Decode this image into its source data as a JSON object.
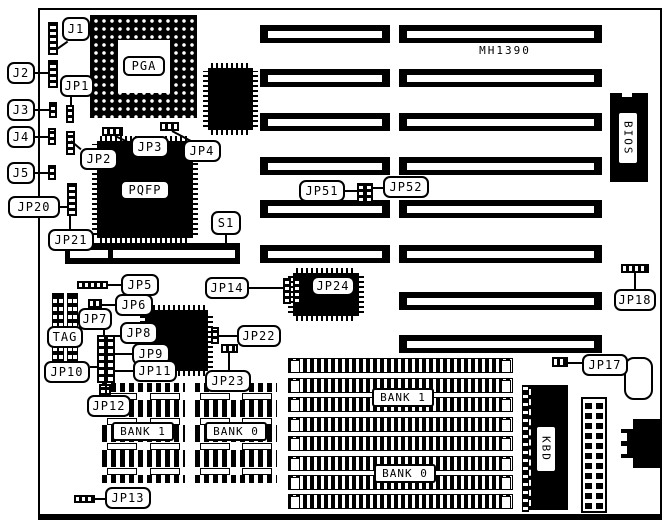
{
  "board": {
    "model": "MH1390"
  },
  "chips": {
    "pga": "PGA",
    "pqfp": "PQFP",
    "bios": "BIOS",
    "kbd": "KBD"
  },
  "callouts": {
    "j1": "J1",
    "j2": "J2",
    "j3": "J3",
    "j4": "J4",
    "j5": "J5",
    "jp1": "JP1",
    "jp2": "JP2",
    "jp3": "JP3",
    "jp4": "JP4",
    "jp5": "JP5",
    "jp6": "JP6",
    "jp7": "JP7",
    "jp8": "JP8",
    "jp9": "JP9",
    "jp10": "JP10",
    "jp11": "JP11",
    "jp12": "JP12",
    "jp13": "JP13",
    "jp14": "JP14",
    "jp17": "JP17",
    "jp18": "JP18",
    "jp20": "JP20",
    "jp21": "JP21",
    "jp22": "JP22",
    "jp23": "JP23",
    "jp24": "JP24",
    "jp51": "JP51",
    "jp52": "JP52",
    "s1": "S1",
    "tag": "TAG"
  },
  "memory": {
    "small_bank_left": "BANK 1",
    "small_bank_right": "BANK 0",
    "large_bank_top": "BANK 1",
    "large_bank_bottom": "BANK 0"
  },
  "expansion_slots": {
    "left_column_count": 6,
    "right_column_count": 8
  },
  "colors": {
    "ink": "#000000",
    "paper": "#ffffff"
  }
}
